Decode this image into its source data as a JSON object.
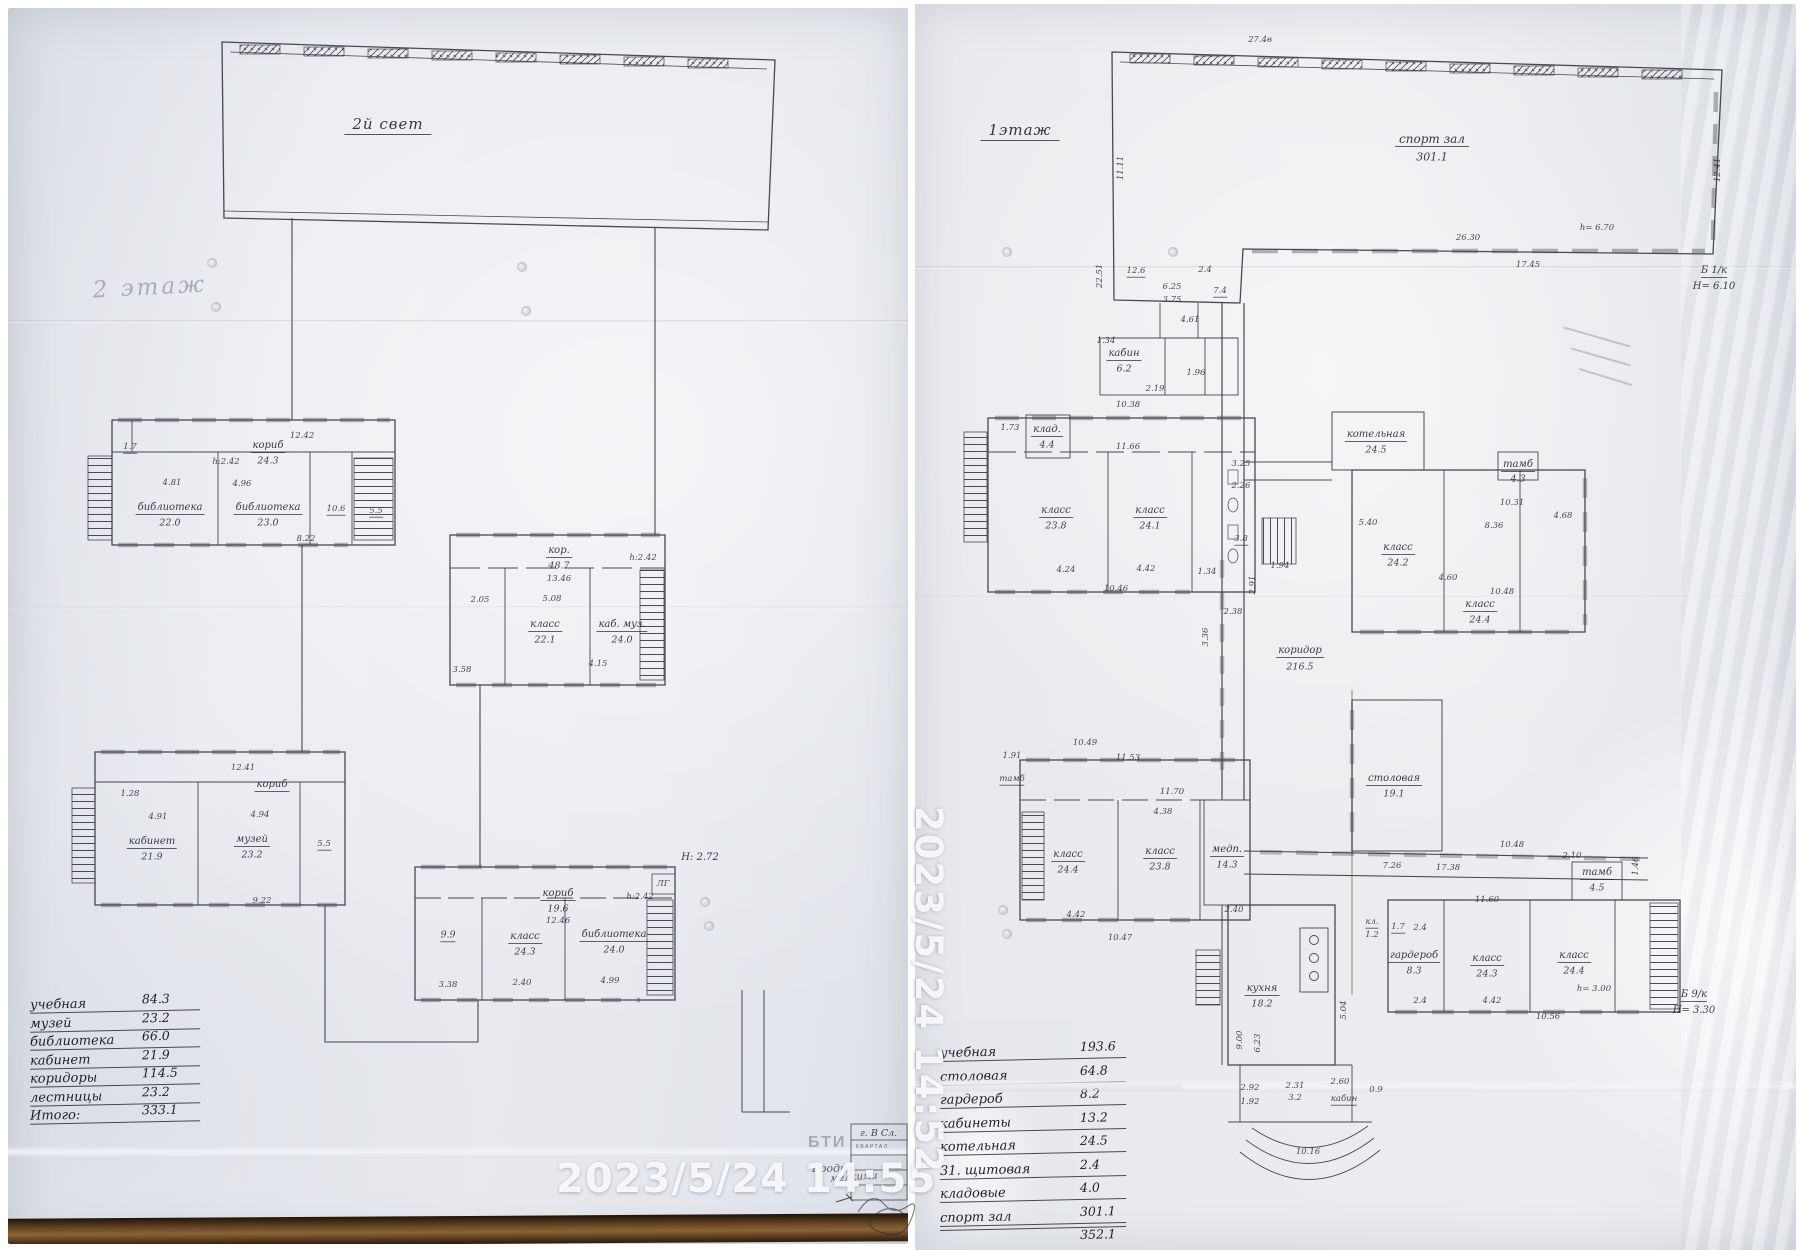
{
  "left_page": {
    "timestamp": "2023/5/24  14:55",
    "floor_note": "2 этаж",
    "hall_label": "2й свет",
    "stamp": {
      "org": "БТИ",
      "city": "Гродно",
      "line1": "г. В Сл.",
      "line2": "КВАРТАЛ",
      "note": "мелкими"
    },
    "legend": {
      "rows": [
        [
          "учебная",
          "84.3"
        ],
        [
          "музей",
          "23.2"
        ],
        [
          "библиотека",
          "66.0"
        ],
        [
          "кабинет",
          "21.9"
        ],
        [
          "коридоры",
          "114.5"
        ],
        [
          "лестницы",
          "23.2"
        ],
        [
          "Итого:",
          "333.1"
        ]
      ]
    },
    "annotations": [
      {
        "t": "2й свет",
        "x": 388,
        "y": 126,
        "s": "h"
      },
      {
        "t": "2 этаж",
        "x": 150,
        "y": 288,
        "s": "p",
        "r": -3
      },
      {
        "t": "кориб",
        "x": 268,
        "y": 447,
        "s": "n"
      },
      {
        "t": "24.3",
        "x": 268,
        "y": 461,
        "s": "a"
      },
      {
        "t": "12.42",
        "x": 302,
        "y": 436,
        "s": "d"
      },
      {
        "t": "h:2.42",
        "x": 226,
        "y": 462,
        "s": "d"
      },
      {
        "t": "1.7",
        "x": 130,
        "y": 448,
        "s": "d",
        "u": 1
      },
      {
        "t": "4.81",
        "x": 172,
        "y": 483,
        "s": "d"
      },
      {
        "t": "4.96",
        "x": 242,
        "y": 484,
        "s": "d"
      },
      {
        "t": "библиотека",
        "x": 170,
        "y": 509,
        "s": "n"
      },
      {
        "t": "22.0",
        "x": 170,
        "y": 523,
        "s": "a"
      },
      {
        "t": "библиотека",
        "x": 268,
        "y": 509,
        "s": "n"
      },
      {
        "t": "23.0",
        "x": 268,
        "y": 523,
        "s": "a"
      },
      {
        "t": "10.6",
        "x": 336,
        "y": 510,
        "s": "d",
        "u": 1
      },
      {
        "t": "5.5",
        "x": 376,
        "y": 512,
        "s": "d",
        "u": 1
      },
      {
        "t": "8.22",
        "x": 306,
        "y": 539,
        "s": "d"
      },
      {
        "t": "кор.",
        "x": 559,
        "y": 552,
        "s": "n"
      },
      {
        "t": "48.7",
        "x": 559,
        "y": 566,
        "s": "a"
      },
      {
        "t": "13.46",
        "x": 559,
        "y": 579,
        "s": "d"
      },
      {
        "t": "h:2.42",
        "x": 643,
        "y": 558,
        "s": "d"
      },
      {
        "t": "2.05",
        "x": 480,
        "y": 600,
        "s": "d"
      },
      {
        "t": "5.08",
        "x": 552,
        "y": 599,
        "s": "d"
      },
      {
        "t": "класс",
        "x": 545,
        "y": 626,
        "s": "n"
      },
      {
        "t": "22.1",
        "x": 545,
        "y": 640,
        "s": "a"
      },
      {
        "t": "каб. муз.",
        "x": 622,
        "y": 626,
        "s": "n"
      },
      {
        "t": "24.0",
        "x": 622,
        "y": 640,
        "s": "a"
      },
      {
        "t": "3.58",
        "x": 462,
        "y": 670,
        "s": "d"
      },
      {
        "t": "4.15",
        "x": 598,
        "y": 664,
        "s": "d"
      },
      {
        "t": "12.41",
        "x": 243,
        "y": 768,
        "s": "d"
      },
      {
        "t": "кориб",
        "x": 272,
        "y": 786,
        "s": "n"
      },
      {
        "t": "1.28",
        "x": 130,
        "y": 794,
        "s": "d"
      },
      {
        "t": "4.91",
        "x": 158,
        "y": 817,
        "s": "d"
      },
      {
        "t": "4.94",
        "x": 260,
        "y": 815,
        "s": "d"
      },
      {
        "t": "кабинет",
        "x": 152,
        "y": 843,
        "s": "n"
      },
      {
        "t": "21.9",
        "x": 152,
        "y": 857,
        "s": "a"
      },
      {
        "t": "музей",
        "x": 252,
        "y": 841,
        "s": "n"
      },
      {
        "t": "23.2",
        "x": 252,
        "y": 855,
        "s": "a"
      },
      {
        "t": "5.5",
        "x": 324,
        "y": 845,
        "s": "d",
        "u": 1
      },
      {
        "t": "9.22",
        "x": 262,
        "y": 901,
        "s": "d"
      },
      {
        "t": "кориб",
        "x": 558,
        "y": 895,
        "s": "n"
      },
      {
        "t": "19.6",
        "x": 558,
        "y": 909,
        "s": "a"
      },
      {
        "t": "12.46",
        "x": 558,
        "y": 921,
        "s": "d"
      },
      {
        "t": "h:2.42",
        "x": 640,
        "y": 897,
        "s": "d"
      },
      {
        "t": "ЛГ",
        "x": 663,
        "y": 884,
        "s": "d"
      },
      {
        "t": "Н: 2.72",
        "x": 700,
        "y": 858,
        "s": "d2"
      },
      {
        "t": "9.9",
        "x": 448,
        "y": 936,
        "s": "a",
        "u": 1
      },
      {
        "t": "класс",
        "x": 525,
        "y": 938,
        "s": "n"
      },
      {
        "t": "24.3",
        "x": 525,
        "y": 952,
        "s": "a"
      },
      {
        "t": "библиотека",
        "x": 614,
        "y": 936,
        "s": "n"
      },
      {
        "t": "24.0",
        "x": 614,
        "y": 950,
        "s": "a"
      },
      {
        "t": "3.38",
        "x": 448,
        "y": 985,
        "s": "d"
      },
      {
        "t": "2.40",
        "x": 522,
        "y": 983,
        "s": "d"
      },
      {
        "t": "4.99",
        "x": 610,
        "y": 981,
        "s": "d"
      }
    ]
  },
  "right_page": {
    "timestamp": "2023/5/24  14:52",
    "legend_rows": [
      [
        "учебная",
        "193.6"
      ],
      [
        "столовая",
        "64.8"
      ],
      [
        "гардероб",
        "8.2"
      ],
      [
        "кабинеты",
        "13.2"
      ],
      [
        "котельная",
        "24.5"
      ],
      [
        "31. щитовая",
        "2.4"
      ],
      [
        "кладовые",
        "4.0"
      ],
      [
        "спорт зал",
        "301.1"
      ],
      [
        "",
        "352.1"
      ],
      [
        "коридоры",
        ""
      ]
    ],
    "annotations": [
      {
        "t": "1этаж",
        "x": 1020,
        "y": 132,
        "s": "h"
      },
      {
        "t": "спорт зал",
        "x": 1432,
        "y": 140,
        "s": "n2"
      },
      {
        "t": "301.1",
        "x": 1432,
        "y": 157,
        "s": "a2"
      },
      {
        "t": "27.4в",
        "x": 1260,
        "y": 40,
        "s": "d"
      },
      {
        "t": "11.11",
        "x": 1121,
        "y": 168,
        "s": "v"
      },
      {
        "t": "22.51",
        "x": 1100,
        "y": 276,
        "s": "v"
      },
      {
        "t": "12.41",
        "x": 1718,
        "y": 170,
        "s": "v"
      },
      {
        "t": "26.30",
        "x": 1468,
        "y": 238,
        "s": "d"
      },
      {
        "t": "h= 6.70",
        "x": 1597,
        "y": 228,
        "s": "d"
      },
      {
        "t": "17.45",
        "x": 1528,
        "y": 265,
        "s": "d"
      },
      {
        "t": "Б 1/к",
        "x": 1714,
        "y": 272,
        "s": "d2",
        "u": 1
      },
      {
        "t": "Н= 6.10",
        "x": 1714,
        "y": 287,
        "s": "d2"
      },
      {
        "t": "12.6",
        "x": 1136,
        "y": 272,
        "s": "d",
        "u": 1
      },
      {
        "t": "6.25",
        "x": 1172,
        "y": 287,
        "s": "d"
      },
      {
        "t": "3.75",
        "x": 1172,
        "y": 300,
        "s": "d"
      },
      {
        "t": "2.4",
        "x": 1205,
        "y": 270,
        "s": "d"
      },
      {
        "t": "7.4",
        "x": 1220,
        "y": 292,
        "s": "d",
        "u": 1
      },
      {
        "t": "4.61",
        "x": 1190,
        "y": 320,
        "s": "d"
      },
      {
        "t": "кабин",
        "x": 1124,
        "y": 355,
        "s": "n"
      },
      {
        "t": "6.2",
        "x": 1124,
        "y": 369,
        "s": "a"
      },
      {
        "t": "1.34",
        "x": 1106,
        "y": 341,
        "s": "d"
      },
      {
        "t": "2.19",
        "x": 1155,
        "y": 389,
        "s": "d"
      },
      {
        "t": "1.96",
        "x": 1196,
        "y": 373,
        "s": "d"
      },
      {
        "t": "клад.",
        "x": 1047,
        "y": 431,
        "s": "n"
      },
      {
        "t": "4.4",
        "x": 1047,
        "y": 445,
        "s": "a"
      },
      {
        "t": "10.38",
        "x": 1128,
        "y": 405,
        "s": "d"
      },
      {
        "t": "1.73",
        "x": 1010,
        "y": 428,
        "s": "d"
      },
      {
        "t": "11.66",
        "x": 1128,
        "y": 447,
        "s": "d"
      },
      {
        "t": "класс",
        "x": 1056,
        "y": 512,
        "s": "n"
      },
      {
        "t": "23.8",
        "x": 1056,
        "y": 526,
        "s": "a"
      },
      {
        "t": "класс",
        "x": 1150,
        "y": 512,
        "s": "n"
      },
      {
        "t": "24.1",
        "x": 1150,
        "y": 526,
        "s": "a"
      },
      {
        "t": "3.25",
        "x": 1241,
        "y": 464,
        "s": "d"
      },
      {
        "t": "2.26",
        "x": 1241,
        "y": 486,
        "s": "d"
      },
      {
        "t": "3.8",
        "x": 1241,
        "y": 540,
        "s": "d",
        "u": 1
      },
      {
        "t": "4.24",
        "x": 1066,
        "y": 570,
        "s": "d"
      },
      {
        "t": "4.42",
        "x": 1146,
        "y": 569,
        "s": "d"
      },
      {
        "t": "10.46",
        "x": 1116,
        "y": 589,
        "s": "d"
      },
      {
        "t": "1.34",
        "x": 1207,
        "y": 572,
        "s": "d"
      },
      {
        "t": "2.91",
        "x": 1253,
        "y": 585,
        "s": "v"
      },
      {
        "t": "5.40",
        "x": 1368,
        "y": 523,
        "s": "d"
      },
      {
        "t": "1.94",
        "x": 1280,
        "y": 566,
        "s": "d"
      },
      {
        "t": "коридор",
        "x": 1300,
        "y": 652,
        "s": "n"
      },
      {
        "t": "216.5",
        "x": 1300,
        "y": 667,
        "s": "a"
      },
      {
        "t": "3.36",
        "x": 1206,
        "y": 637,
        "s": "v"
      },
      {
        "t": "2.38",
        "x": 1233,
        "y": 612,
        "s": "d"
      },
      {
        "t": "котельная",
        "x": 1376,
        "y": 436,
        "s": "n"
      },
      {
        "t": "24.5",
        "x": 1376,
        "y": 450,
        "s": "a"
      },
      {
        "t": "10.31",
        "x": 1512,
        "y": 503,
        "s": "d"
      },
      {
        "t": "8.36",
        "x": 1494,
        "y": 526,
        "s": "d"
      },
      {
        "t": "тамб",
        "x": 1518,
        "y": 466,
        "s": "n"
      },
      {
        "t": "4.3",
        "x": 1518,
        "y": 479,
        "s": "a"
      },
      {
        "t": "4.68",
        "x": 1563,
        "y": 516,
        "s": "d"
      },
      {
        "t": "класс",
        "x": 1398,
        "y": 549,
        "s": "n"
      },
      {
        "t": "24.2",
        "x": 1398,
        "y": 563,
        "s": "a"
      },
      {
        "t": "класс",
        "x": 1480,
        "y": 606,
        "s": "n"
      },
      {
        "t": "24.4",
        "x": 1480,
        "y": 620,
        "s": "a"
      },
      {
        "t": "4.60",
        "x": 1448,
        "y": 578,
        "s": "d"
      },
      {
        "t": "10.48",
        "x": 1502,
        "y": 592,
        "s": "d"
      },
      {
        "t": "1.91",
        "x": 1012,
        "y": 756,
        "s": "d"
      },
      {
        "t": "10.49",
        "x": 1085,
        "y": 743,
        "s": "d"
      },
      {
        "t": "11.53",
        "x": 1128,
        "y": 758,
        "s": "d"
      },
      {
        "t": "тамб",
        "x": 1012,
        "y": 780,
        "s": "d",
        "u": 1
      },
      {
        "t": "11.70",
        "x": 1172,
        "y": 792,
        "s": "d"
      },
      {
        "t": "4.38",
        "x": 1163,
        "y": 812,
        "s": "d"
      },
      {
        "t": "класс",
        "x": 1068,
        "y": 856,
        "s": "n"
      },
      {
        "t": "24.4",
        "x": 1068,
        "y": 870,
        "s": "a"
      },
      {
        "t": "класс",
        "x": 1160,
        "y": 853,
        "s": "n"
      },
      {
        "t": "23.8",
        "x": 1160,
        "y": 867,
        "s": "a"
      },
      {
        "t": "медп.",
        "x": 1227,
        "y": 851,
        "s": "n"
      },
      {
        "t": "14.3",
        "x": 1227,
        "y": 865,
        "s": "a"
      },
      {
        "t": "4.42",
        "x": 1076,
        "y": 915,
        "s": "d"
      },
      {
        "t": "10.47",
        "x": 1120,
        "y": 938,
        "s": "d"
      },
      {
        "t": "2.40",
        "x": 1234,
        "y": 910,
        "s": "d"
      },
      {
        "t": "столовая",
        "x": 1394,
        "y": 780,
        "s": "n"
      },
      {
        "t": "19.1",
        "x": 1394,
        "y": 794,
        "s": "a"
      },
      {
        "t": "10.48",
        "x": 1512,
        "y": 845,
        "s": "d"
      },
      {
        "t": "17.38",
        "x": 1448,
        "y": 868,
        "s": "d"
      },
      {
        "t": "11.60",
        "x": 1487,
        "y": 900,
        "s": "d"
      },
      {
        "t": "7.26",
        "x": 1392,
        "y": 866,
        "s": "d"
      },
      {
        "t": "2.10",
        "x": 1572,
        "y": 856,
        "s": "d"
      },
      {
        "t": "1.46",
        "x": 1636,
        "y": 866,
        "s": "v"
      },
      {
        "t": "тамб",
        "x": 1597,
        "y": 874,
        "s": "n"
      },
      {
        "t": "4.5",
        "x": 1597,
        "y": 888,
        "s": "a"
      },
      {
        "t": "гардероб",
        "x": 1414,
        "y": 957,
        "s": "n"
      },
      {
        "t": "8.3",
        "x": 1414,
        "y": 971,
        "s": "a"
      },
      {
        "t": "класс",
        "x": 1487,
        "y": 960,
        "s": "n"
      },
      {
        "t": "24.3",
        "x": 1487,
        "y": 974,
        "s": "a"
      },
      {
        "t": "класс",
        "x": 1574,
        "y": 957,
        "s": "n"
      },
      {
        "t": "24.4",
        "x": 1574,
        "y": 971,
        "s": "a"
      },
      {
        "t": "h= 3.00",
        "x": 1594,
        "y": 989,
        "s": "d"
      },
      {
        "t": "4.42",
        "x": 1492,
        "y": 1001,
        "s": "d"
      },
      {
        "t": "10.56",
        "x": 1548,
        "y": 1017,
        "s": "d"
      },
      {
        "t": "2.4",
        "x": 1420,
        "y": 1001,
        "s": "d"
      },
      {
        "t": "Б 9/к",
        "x": 1694,
        "y": 996,
        "s": "d2",
        "u": 1
      },
      {
        "t": "Н= 3.30",
        "x": 1694,
        "y": 1011,
        "s": "d2"
      },
      {
        "t": "кл.",
        "x": 1372,
        "y": 923,
        "s": "d",
        "u": 1
      },
      {
        "t": "1.2",
        "x": 1372,
        "y": 935,
        "s": "d"
      },
      {
        "t": "1.7",
        "x": 1398,
        "y": 928,
        "s": "d",
        "u": 1
      },
      {
        "t": "2.4",
        "x": 1420,
        "y": 928,
        "s": "d"
      },
      {
        "t": "кухня",
        "x": 1262,
        "y": 990,
        "s": "n"
      },
      {
        "t": "18.2",
        "x": 1262,
        "y": 1004,
        "s": "a"
      },
      {
        "t": "9.00",
        "x": 1240,
        "y": 1040,
        "s": "v"
      },
      {
        "t": "6.23",
        "x": 1258,
        "y": 1043,
        "s": "v"
      },
      {
        "t": "5.04",
        "x": 1344,
        "y": 1010,
        "s": "v"
      },
      {
        "t": "2.92",
        "x": 1250,
        "y": 1088,
        "s": "d"
      },
      {
        "t": "1.92",
        "x": 1250,
        "y": 1102,
        "s": "d"
      },
      {
        "t": "2.31",
        "x": 1295,
        "y": 1086,
        "s": "d"
      },
      {
        "t": "3.2",
        "x": 1295,
        "y": 1098,
        "s": "d"
      },
      {
        "t": "2.60",
        "x": 1340,
        "y": 1082,
        "s": "d"
      },
      {
        "t": "кабин",
        "x": 1344,
        "y": 1100,
        "s": "d",
        "u": 1
      },
      {
        "t": "0.9",
        "x": 1376,
        "y": 1090,
        "s": "d"
      },
      {
        "t": "10.16",
        "x": 1308,
        "y": 1152,
        "s": "d"
      }
    ]
  }
}
